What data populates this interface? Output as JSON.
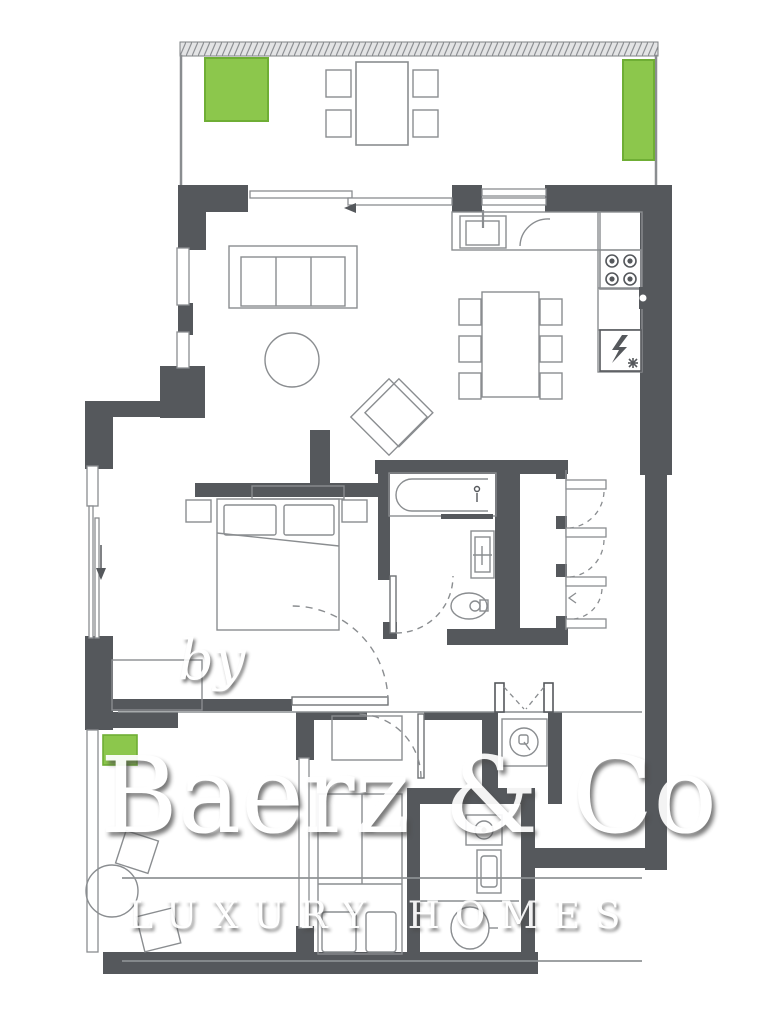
{
  "watermark": {
    "by": "by",
    "brand": "Baerz & Co",
    "tagline": "LUXURY HOMES"
  },
  "colors": {
    "wall": "#55585c",
    "thin_line": "#8a8d90",
    "accent_green": "#8cc74c",
    "accent_green_border": "#6fae35",
    "watermark_text": "#ffffff",
    "watermark_rule": "#8d9093"
  },
  "icons": [
    "planter-icon",
    "terrace-table-icon",
    "sofa-icon",
    "coffee-table-icon",
    "armchair-icon",
    "sink-icon",
    "hob-icon",
    "fridge-icon",
    "dining-table-icon",
    "bed-icon",
    "pillow-icon",
    "bathtub-icon",
    "washbasin-icon",
    "toilet-icon",
    "door-swing-arc",
    "closet-shelf-icon",
    "entrance-double-door-icon",
    "washing-machine-icon",
    "window-glazing",
    "sliding-door-icon"
  ]
}
